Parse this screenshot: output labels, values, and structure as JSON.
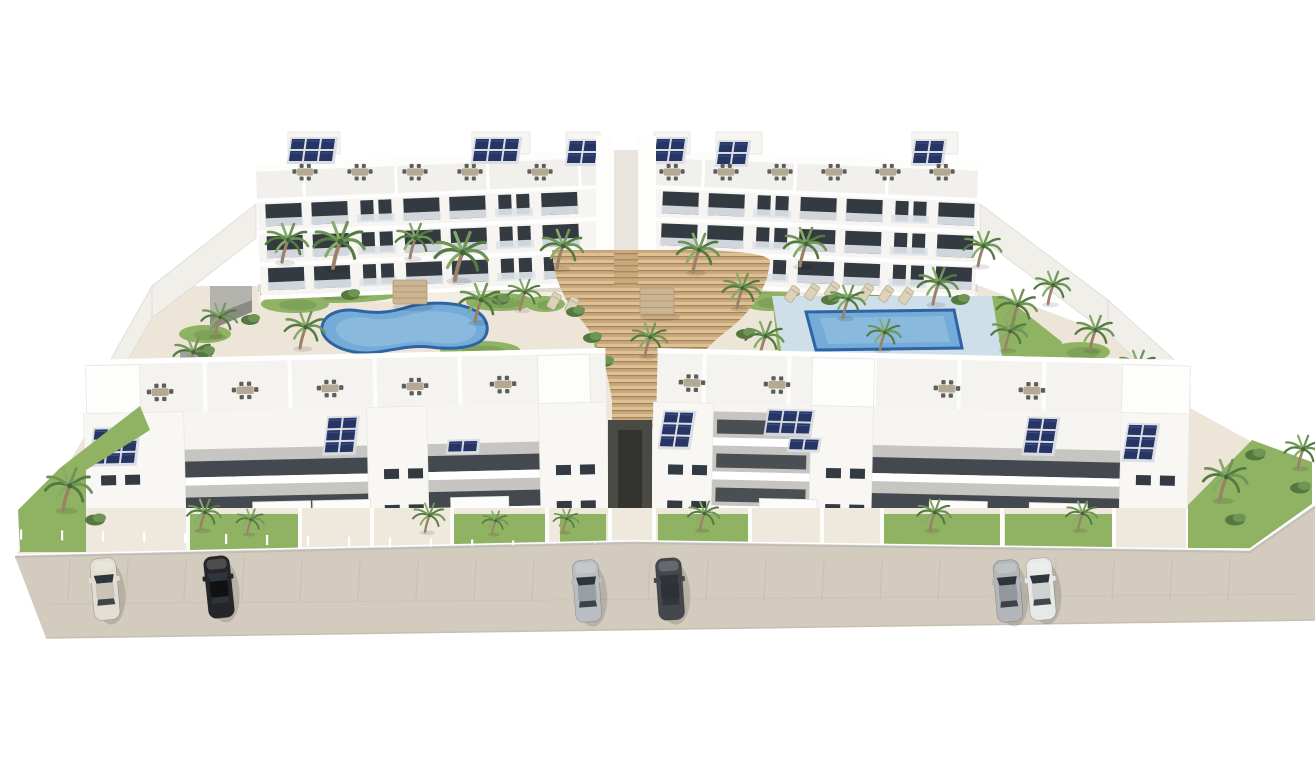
{
  "scene": {
    "type": "architectural-render",
    "description": "Aerial 3D rendering of a white Mediterranean apartment complex: a long rear apartment block with rooftop terraces and solar panels, a landscaped courtyard with a freeform pool, a rectangular pool and curved timber stairs, a front row of apartments with solar roofs and private gardens, palm trees throughout, and six cars parked on the beige street in front."
  },
  "palette": {
    "white_wall": "#f6f5f2",
    "wall_shade": "#e7e6e2",
    "parapet": "#fdfdfc",
    "recess_gray": "#c6c5c1",
    "opening_dark": "#343a41",
    "railing": "#dde4e8",
    "ground": "#ece5d8",
    "path_light": "#f3eee4",
    "lawn": "#8fb263",
    "lawn_dark": "#6d9150",
    "frond": "#6f9556",
    "frond_dark": "#527a41",
    "frond_light": "#85ad68",
    "trunk": "#9a8266",
    "pool_rim": "#2e63a4",
    "pool_water": "#74abd8",
    "pool_light": "#9cc4e4",
    "pool_deck": "#cfdfe9",
    "wood": "#c9a87b",
    "wood_light": "#ddc093",
    "wood_dark": "#9a7b57",
    "street": "#d3cbbe",
    "street_line": "#c0b8aa",
    "solar": "#273564",
    "solar_frame": "#d9dce2",
    "furniture_dark": "#5f5f5a",
    "furniture_tan": "#b3a995",
    "glass_fence": "#c9d3d8",
    "alley_dark": "#4a4a45",
    "gray_block": "#b5b3ae"
  },
  "back_building": {
    "wings": [
      {
        "x1": 258,
        "x2": 598,
        "tilt": -2.3,
        "pivot_x": 598
      },
      {
        "x1": 654,
        "x2": 978,
        "tilt": 2.3,
        "pivot_x": 654
      }
    ],
    "roof_y": 150,
    "terrace_y": 158,
    "floors_y": [
      188,
      220,
      252
    ],
    "base_y": 286,
    "module_w": 46,
    "roof_volumes": [
      [
        288,
        52
      ],
      [
        472,
        58
      ],
      [
        566,
        34
      ],
      [
        654,
        36
      ],
      [
        716,
        46
      ],
      [
        912,
        46
      ]
    ],
    "solar_arrays": [
      {
        "x": 292,
        "y": 139,
        "cols": 3,
        "rows": 2
      },
      {
        "x": 476,
        "y": 139,
        "cols": 3,
        "rows": 2
      },
      {
        "x": 570,
        "y": 141,
        "cols": 2,
        "rows": 2
      },
      {
        "x": 657,
        "y": 139,
        "cols": 2,
        "rows": 2
      },
      {
        "x": 720,
        "y": 142,
        "cols": 2,
        "rows": 2
      },
      {
        "x": 916,
        "y": 141,
        "cols": 2,
        "rows": 2
      }
    ],
    "terrace_furniture_x": [
      305,
      360,
      415,
      470,
      540,
      672,
      726,
      780,
      834,
      888,
      942
    ],
    "core": {
      "tower1": [
        596,
        614
      ],
      "tower2": [
        638,
        656
      ],
      "gap": [
        614,
        638
      ],
      "top_y": 136
    }
  },
  "walls": [
    {
      "pts": "256,204 256,238 152,318 152,286"
    },
    {
      "pts": "152,286 152,318 88,430 88,400"
    },
    {
      "pts": "980,204 980,238 1108,334 1108,300"
    },
    {
      "pts": "1108,300 1108,334 1190,408 1190,374"
    }
  ],
  "gray_structures": [
    {
      "pts": "210,286 252,286 252,300 210,316",
      "fill": "#b5b3ae"
    },
    {
      "pts": "210,316 252,300 252,312 210,330",
      "fill": "#8b8a85"
    },
    {
      "pts": "180,350 208,350 208,370 180,370",
      "fill": "#9fa0a2"
    }
  ],
  "courtyard": {
    "ground_pts": "152,286 980,286 1108,334 1190,408 1252,442 1252,549 632,541 15,557 88,430 152,318",
    "walk_band": [
      258,
      288,
      720,
      14
    ],
    "lawn_blobs": [
      [
        330,
        294,
        70,
        9
      ],
      [
        740,
        294,
        60,
        8
      ],
      [
        880,
        294,
        55,
        8
      ],
      [
        500,
        302,
        34,
        9
      ],
      [
        295,
        304,
        34,
        9
      ],
      [
        205,
        334,
        26,
        9
      ],
      [
        232,
        372,
        22,
        8
      ],
      [
        545,
        304,
        20,
        8
      ],
      [
        700,
        390,
        34,
        10
      ],
      [
        770,
        302,
        28,
        9
      ],
      [
        1080,
        352,
        30,
        10
      ],
      [
        1122,
        392,
        28,
        10
      ],
      [
        1160,
        432,
        26,
        9
      ],
      [
        480,
        350,
        40,
        9
      ],
      [
        620,
        345,
        26,
        8
      ]
    ],
    "lawn_patch_pts": "772,296 1004,296 1062,342 1052,392 782,392"
  },
  "stairs": {
    "path": "M 552 250 L 700 250 Q 772 252 770 262 Q 766 300 728 330 Q 690 358 678 398 L 676 430 L 612 430 L 612 400 Q 604 344 578 316 Q 554 288 552 250 Z",
    "stripe_top": 246,
    "stripe_bottom": 430,
    "stripe_step": 7,
    "gap_steps": [
      614,
      250,
      24,
      38
    ]
  },
  "pools": {
    "left": {
      "rim_path": "M 322 331 C 320 316 338 307 360 311 C 378 314 392 312 408 307 C 428 301 458 302 474 310 C 488 317 490 330 484 338 C 476 348 452 350 430 347 C 412 345 398 349 378 352 C 352 356 326 346 322 331 Z",
      "inner_path": "M 336 330 C 336 320 352 315 368 318 C 384 321 398 318 412 314 C 430 309 456 311 468 318 C 478 324 478 332 472 337 C 464 344 448 345 430 342 C 414 340 400 344 382 346 C 360 349 338 341 336 330 Z"
    },
    "right": {
      "deck_pts": "772,296 992,296 1002,356 782,356",
      "water_pts": "806,312 954,310 962,348 816,350"
    }
  },
  "pergolas": [
    {
      "x": 393,
      "y": 280,
      "w": 34,
      "h": 24
    },
    {
      "x": 640,
      "y": 288,
      "w": 34,
      "h": 26
    }
  ],
  "loungers": [
    [
      792,
      294,
      35
    ],
    [
      812,
      292,
      35
    ],
    [
      832,
      290,
      35
    ],
    [
      866,
      292,
      35
    ],
    [
      886,
      294,
      35
    ],
    [
      906,
      296,
      35
    ],
    [
      300,
      377,
      62
    ],
    [
      320,
      381,
      62
    ],
    [
      340,
      385,
      62
    ],
    [
      554,
      301,
      28
    ],
    [
      572,
      305,
      28
    ]
  ],
  "front_left_block": {
    "x1": 85,
    "x2": 608,
    "tilt": -1.3,
    "pivot_x": 608,
    "roofband_y": 348,
    "facade_y": 402,
    "base_y": 542,
    "separators_x": [
      120,
      205,
      290,
      375,
      460
    ],
    "roof_furniture_x": [
      162,
      247,
      332,
      417,
      505
    ],
    "roof_volumes": [
      [
        88,
        54
      ],
      [
        540,
        52
      ]
    ],
    "towers": [
      [
        85,
        185
      ],
      [
        368,
        428
      ],
      [
        540,
        608
      ]
    ],
    "band_segments": [
      [
        185,
        368
      ],
      [
        428,
        540
      ]
    ],
    "awnings": [
      [
        252,
        494
      ],
      [
        312,
        494
      ],
      [
        450,
        494
      ]
    ],
    "solar_arrays": [
      {
        "x": 96,
        "y": 418,
        "cols": 3,
        "rows": 3
      },
      {
        "x": 330,
        "y": 412,
        "cols": 2,
        "rows": 3
      },
      {
        "x": 450,
        "y": 438,
        "cols": 2,
        "rows": 1
      }
    ]
  },
  "front_right_block": {
    "x1": 652,
    "x2": 1188,
    "tilt": 1.3,
    "pivot_x": 652,
    "roofband_y": 348,
    "facade_y": 402,
    "base_y": 542,
    "separators_x": [
      700,
      785,
      870,
      955,
      1040
    ],
    "roof_furniture_x": [
      690,
      775,
      945,
      1030
    ],
    "roof_volumes": [
      [
        810,
        62
      ],
      [
        1120,
        68
      ]
    ],
    "towers": [
      [
        652,
        712
      ],
      [
        810,
        872
      ],
      [
        1120,
        1188
      ]
    ],
    "band_segments": [
      [
        872,
        1120
      ]
    ],
    "recessed_section": {
      "x": 712,
      "w": 98,
      "bands_y": [
        410,
        444,
        478
      ]
    },
    "awnings": [
      [
        760,
        496
      ],
      [
        930,
        494
      ],
      [
        1030,
        494
      ]
    ],
    "solar_arrays": [
      {
        "x": 664,
        "y": 412,
        "cols": 2,
        "rows": 3
      },
      {
        "x": 768,
        "y": 408,
        "cols": 3,
        "rows": 2
      },
      {
        "x": 790,
        "y": 436,
        "cols": 2,
        "rows": 1
      },
      {
        "x": 1028,
        "y": 410,
        "cols": 2,
        "rows": 3
      },
      {
        "x": 1128,
        "y": 414,
        "cols": 2,
        "rows": 3
      }
    ]
  },
  "alley": {
    "x": 608,
    "w": 44,
    "y1": 420,
    "y2": 540
  },
  "gardens": {
    "band": [
      85,
      508,
      1103,
      46
    ],
    "lawns": [
      [
        188,
        110
      ],
      [
        450,
        95
      ],
      [
        560,
        46
      ],
      [
        658,
        90
      ],
      [
        880,
        120
      ],
      [
        1005,
        107
      ]
    ],
    "walls_x": [
      186,
      298,
      370,
      450,
      545,
      608,
      652,
      748,
      820,
      880,
      1000,
      1112,
      1186
    ],
    "left_corner_pts": "20,552 86,552 86,470 150,430 140,406 60,468 18,510",
    "right_corner_pts": "1188,548 1250,548 1312,504 1312,462 1252,440 1188,505"
  },
  "fence": {
    "line_pts": "15,557 632,543 1250,552 1315,507",
    "posts_from": 20,
    "posts_to": 1245,
    "posts_step": 41
  },
  "street": {
    "pts": "15,557 632,543 1250,552 1315,507 1315,620 46,638",
    "parking_lines_x": [
      70,
      128,
      186,
      244,
      302,
      360,
      418,
      476,
      534,
      592,
      650,
      708,
      766,
      824,
      882,
      940,
      998,
      1056,
      1114,
      1172,
      1230
    ],
    "parking_line_y": [
      558,
      602
    ]
  },
  "cars": [
    {
      "name": "cream-sedan",
      "x": 105,
      "y": 589,
      "rot": -5,
      "body": "#e3ded3",
      "roof": "#c9c4b8"
    },
    {
      "name": "black-sedan",
      "x": 219,
      "y": 587,
      "rot": -6,
      "body": "#26262a",
      "roof": "#111114"
    },
    {
      "name": "silver-sedan",
      "x": 587,
      "y": 591,
      "rot": -4,
      "body": "#babdc1",
      "roof": "#9b9fa4"
    },
    {
      "name": "darkgray-sedan",
      "x": 670,
      "y": 589,
      "rot": -4,
      "body": "#44484d",
      "roof": "#2e3237"
    },
    {
      "name": "silver-sedan-2",
      "x": 1008,
      "y": 591,
      "rot": -5,
      "body": "#b2b6ba",
      "roof": "#94989d"
    },
    {
      "name": "white-sedan",
      "x": 1041,
      "y": 589,
      "rot": -5,
      "body": "#e7e8e8",
      "roof": "#cfd1d1"
    }
  ],
  "palms_back": [
    [
      282,
      262,
      1.0
    ],
    [
      333,
      268,
      1.2
    ],
    [
      410,
      258,
      0.9
    ],
    [
      455,
      280,
      1.25
    ],
    [
      557,
      268,
      1.0
    ],
    [
      520,
      310,
      0.8
    ],
    [
      693,
      272,
      1.0
    ],
    [
      737,
      308,
      0.9
    ],
    [
      800,
      266,
      1.0
    ],
    [
      843,
      318,
      0.85
    ],
    [
      880,
      350,
      0.8
    ],
    [
      933,
      304,
      0.95
    ],
    [
      978,
      266,
      0.9
    ],
    [
      1012,
      326,
      0.95
    ],
    [
      1048,
      304,
      0.85
    ],
    [
      1090,
      350,
      0.9
    ],
    [
      1133,
      385,
      0.9
    ],
    [
      1168,
      422,
      0.8
    ],
    [
      215,
      336,
      0.85
    ],
    [
      188,
      372,
      0.9
    ],
    [
      232,
      414,
      0.75
    ],
    [
      300,
      348,
      0.95
    ],
    [
      475,
      322,
      1.0
    ],
    [
      645,
      356,
      0.85
    ],
    [
      760,
      356,
      0.9
    ],
    [
      1005,
      350,
      0.85
    ]
  ],
  "palms_front": [
    [
      200,
      530,
      0.8
    ],
    [
      247,
      534,
      0.65
    ],
    [
      425,
      532,
      0.75
    ],
    [
      492,
      534,
      0.6
    ],
    [
      563,
      532,
      0.6
    ],
    [
      700,
      530,
      0.75
    ],
    [
      930,
      530,
      0.8
    ],
    [
      1078,
      530,
      0.75
    ],
    [
      63,
      510,
      1.1
    ],
    [
      1220,
      500,
      1.05
    ],
    [
      1298,
      468,
      0.85
    ]
  ],
  "bushes_back": [
    [
      575,
      312
    ],
    [
      592,
      338
    ],
    [
      604,
      362
    ],
    [
      745,
      334
    ],
    [
      722,
      362
    ],
    [
      702,
      388
    ],
    [
      350,
      295
    ],
    [
      500,
      300
    ],
    [
      830,
      300
    ],
    [
      960,
      300
    ],
    [
      1095,
      365
    ],
    [
      1140,
      400
    ],
    [
      250,
      320
    ],
    [
      205,
      352
    ]
  ],
  "bushes_front": [
    [
      1235,
      520
    ],
    [
      95,
      520
    ],
    [
      1255,
      455
    ],
    [
      1300,
      488
    ]
  ]
}
